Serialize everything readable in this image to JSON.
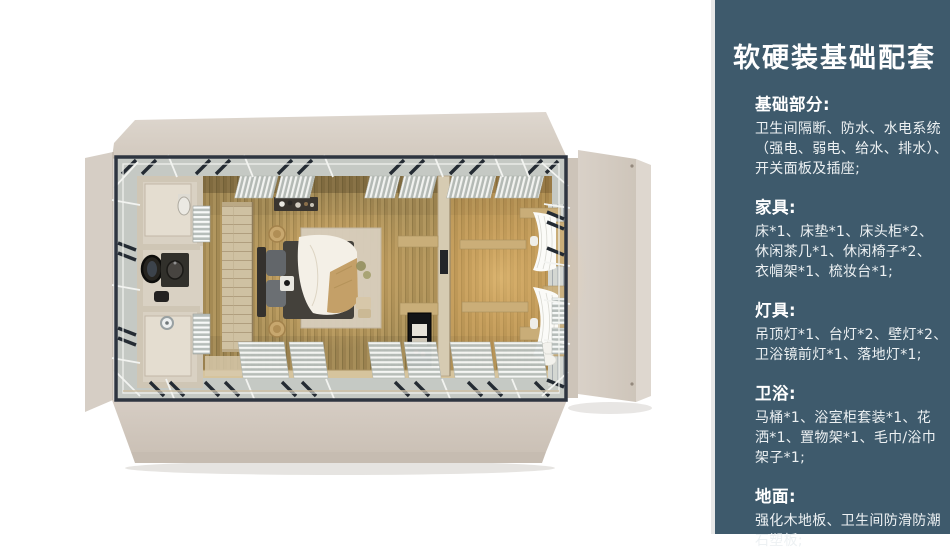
{
  "page": {
    "background": "#ffffff"
  },
  "floorplan": {
    "name": "top-down-render-of-folding-container-bedroom-suite",
    "colors": {
      "background": "#ffffff",
      "panel_beige": "#d6cec5",
      "panel_edge": "#cdc4b9",
      "band_gray": "#c5c9c4",
      "frame_dark": "#2e3540",
      "wood_floor": "#b2975f",
      "glow_warm": "#ffd489",
      "bathroom_wall": "#cfc6b5",
      "duvet_white": "#f4f0e7",
      "blanket_tan": "#c4a068",
      "curtain_white": "#fbfbf8"
    },
    "elements": [
      "fold-out-roof-panels",
      "steel-frame",
      "perimeter-braces",
      "bathroom",
      "vanity-mirror",
      "shower",
      "toilet",
      "towel-racks",
      "wardrobe-partition",
      "double-bed",
      "rug",
      "bedside-shelf",
      "shelving-unit",
      "black-cabinet",
      "window-curtains",
      "wood-slat-floor",
      "white-slat-grilles"
    ]
  },
  "sidebar": {
    "bg_color": "#3e5a6c",
    "text_color": "#f4f7f8",
    "title": "软硬装基础配套",
    "sections": [
      {
        "heading": "基础部分:",
        "body": "卫生间隔断、防水、水电系统\n（强电、弱电、给水、排水）、\n开关面板及插座;"
      },
      {
        "heading": "家具:",
        "body": "床*1、床垫*1、床头柜*2、\n休闲茶几*1、休闲椅子*2、\n衣帽架*1、梳妆台*1;"
      },
      {
        "heading": "灯具:",
        "body": "吊顶灯*1、台灯*2、壁灯*2、\n卫浴镜前灯*1、落地灯*1;"
      },
      {
        "heading": "卫浴:",
        "body": "马桶*1、浴室柜套装*1、花\n洒*1、置物架*1、毛巾/浴巾\n架子*1;"
      },
      {
        "heading": "地面:",
        "body": "强化木地板、卫生间防滑防潮\n石塑板;"
      }
    ]
  }
}
